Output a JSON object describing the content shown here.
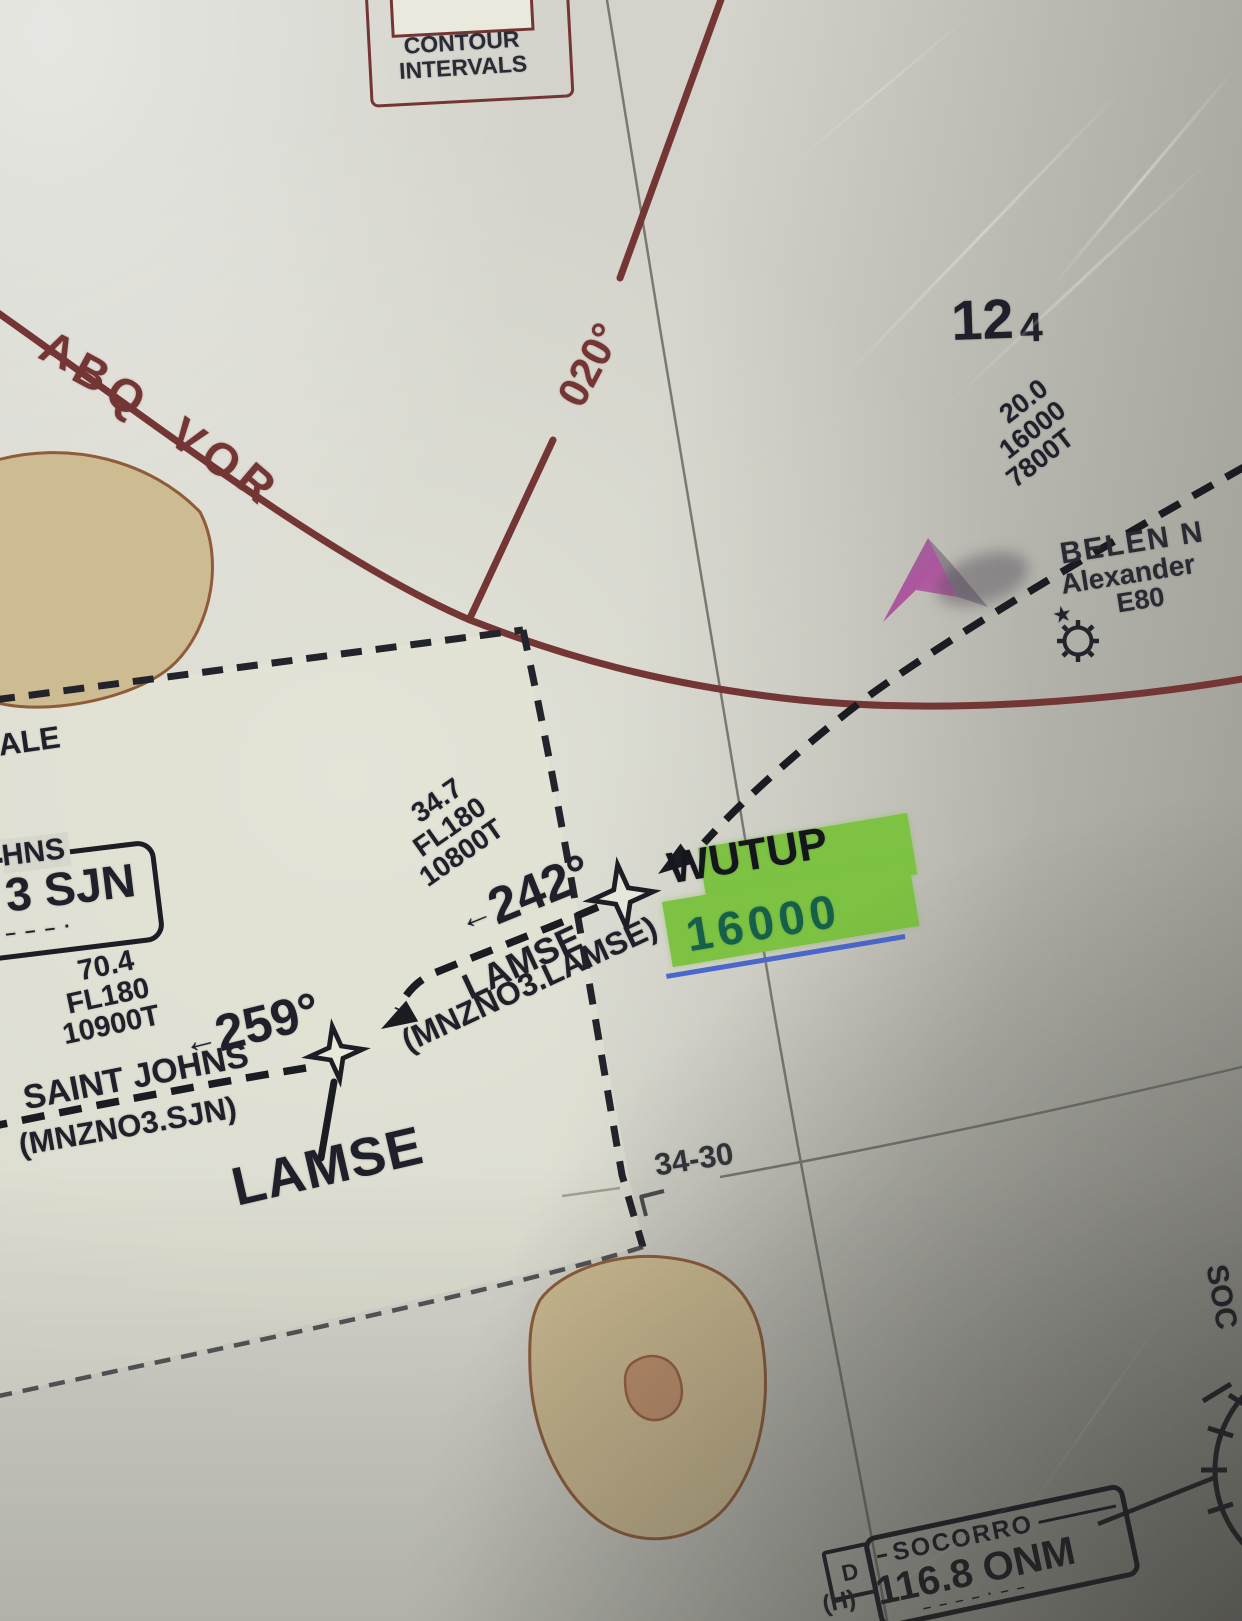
{
  "colors": {
    "maroon": "#743634",
    "ink": "#20202a",
    "green_highlight": "#7dc243",
    "highlight_text_green": "#14604a",
    "blue_underline": "#4b67cc",
    "terrain_fill": "#cdbb92",
    "terrain_stroke": "#8e5c3a"
  },
  "legend": {
    "line1": "CONTOUR",
    "line2": "INTERVALS"
  },
  "vor": {
    "arc_label": "ABQ VOR",
    "radial_label": "020°"
  },
  "mef": {
    "thousands": "12",
    "hundreds": "4"
  },
  "ne_leg": {
    "distance": "20.0",
    "altitude": "16000",
    "temp_alt": "7800T"
  },
  "belen": {
    "name": "BELEN N",
    "name2": "Alexander",
    "ident": "E80",
    "star_icon": "★"
  },
  "wutup": {
    "name": "WUTUP",
    "highlight_alt": "16000",
    "arrow": "←",
    "course": "242°",
    "leg": {
      "distance": "34.7",
      "level": "FL180",
      "temp_alt": "10800T"
    },
    "segment": "LAMSE",
    "segment_sub": "(MNZNO3.LAMSE)"
  },
  "lamse": {
    "name": "LAMSE",
    "arrow": "←",
    "course": "259°",
    "leg": {
      "distance": "70.4",
      "level": "FL180",
      "temp_alt": "10900T"
    },
    "segment": "SAINT JOHNS",
    "segment_sub": "(MNZNO3.SJN)"
  },
  "sjn_box": {
    "name_partial": "HNS",
    "freq_partial": "3 SJN",
    "morse": "– –   – ·"
  },
  "graticule": {
    "lat_label": "34-30"
  },
  "partials": {
    "scale": "ALE",
    "right_edge": "SOC"
  },
  "socorro": {
    "name": "SOCORRO",
    "freq": "116.8 ONM",
    "dme": "D",
    "service": "(H)",
    "morse": "– – –  – ·  – –"
  }
}
